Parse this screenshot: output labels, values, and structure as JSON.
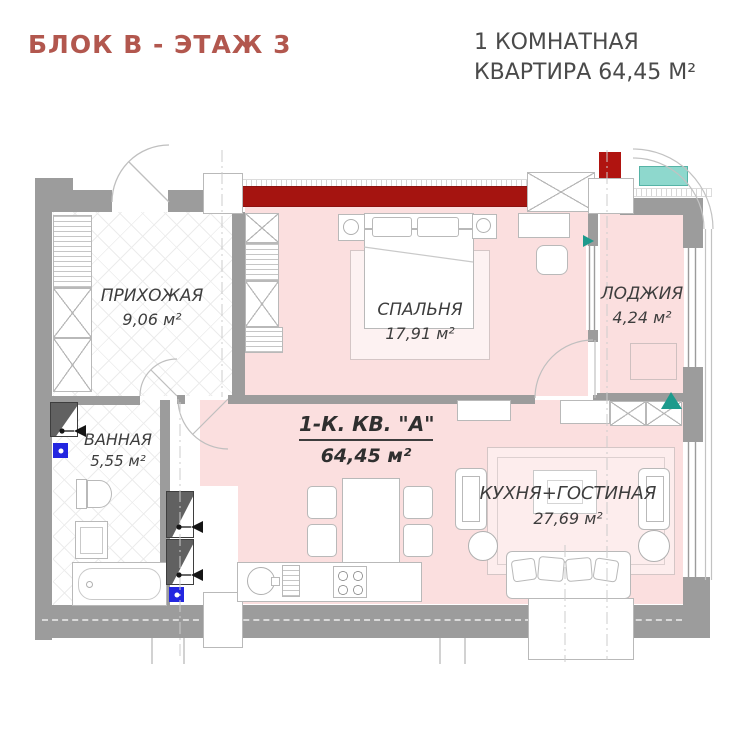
{
  "header": {
    "title": "БЛОК В - ЭТАЖ 3",
    "subtitle_line1": "1 КОМНАТНАЯ",
    "subtitle_line2": "КВАРТИРА 64,45 М²"
  },
  "apartment": {
    "name": "1-К. КВ. \"А\"",
    "area": "64,45 м²"
  },
  "rooms": {
    "hallway": {
      "name": "ПРИХОЖАЯ",
      "area": "9,06 м²"
    },
    "bedroom": {
      "name": "СПАЛЬНЯ",
      "area": "17,91 м²"
    },
    "loggia": {
      "name": "ЛОДЖИЯ",
      "area": "4,24 м²"
    },
    "bathroom": {
      "name": "ВАННАЯ",
      "area": "5,55 м²"
    },
    "kitchen_living": {
      "name": "КУХНЯ+ГОСТИНАЯ",
      "area": "27,69 м²"
    }
  },
  "colors": {
    "accent_title": "#b2574e",
    "room_fill": "#fbdfdf",
    "wall": "#9c9c9c",
    "red_accent_wall": "#a51410",
    "teal_glass": "#8ed8cd",
    "teal_marker": "#1d9a8c",
    "plumbing_blue": "#2326e0",
    "label_text": "#3d3d3d"
  }
}
